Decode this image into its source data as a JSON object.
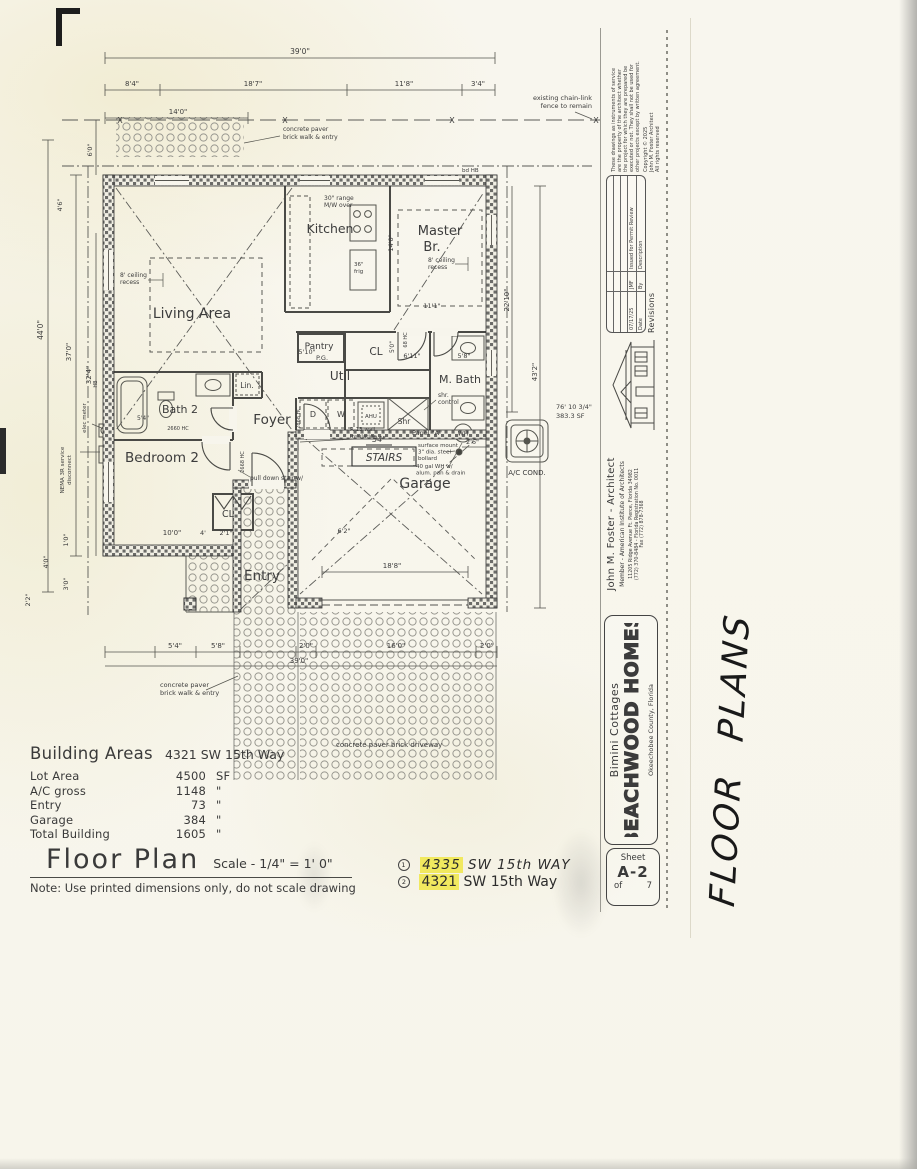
{
  "page": {
    "paper": "#f7f5ec",
    "ink": "#3a3a3a",
    "highlight": "#f1e95f"
  },
  "plan": {
    "rooms": {
      "living": "Living Area",
      "kitchen": "Kitchen",
      "master1": "Master",
      "master2": "Br.",
      "pantry": "Pantry",
      "pg": "P.G.",
      "util": "Util",
      "cl": "CL",
      "mbath": "M. Bath",
      "shr": "Shr",
      "foyer": "Foyer",
      "bath2": "Bath 2",
      "lin": "Lin.",
      "bedroom2": "Bedroom 2",
      "cl2": "CL",
      "entry": "Entry",
      "garage": "Garage",
      "stairs": "STAIRS"
    },
    "dims": {
      "t_overall": "39'0\"",
      "t_a": "8'4\"",
      "t_b": "18'7\"",
      "t_c": "11'8\"",
      "t_d": "3'4\"",
      "t_e": "14'0\"",
      "l_a": "6'0\"",
      "l_b": "4'6\"",
      "l_c": "44'0\"",
      "l_d": "37'0\"",
      "l_e": "32'4\"",
      "l_f": "1'0\"",
      "l_g": "4'0\"",
      "l_h": "3'0\"",
      "l_i": "2'2\"",
      "r_a": "22'10\"",
      "r_b": "43'2\"",
      "r_c": "76' 10 3/4\"",
      "r_d": "383.3 SF",
      "r_e": "2'6\"",
      "b_a": "5'4\"",
      "b_b": "5'8\"",
      "b_c": "2'0\"",
      "b_d": "16'0\"",
      "b_e": "2'0\"",
      "b_f": "39'0\"",
      "i_a": "14'0\"",
      "i_b": "11'1\"",
      "i_c": "5'0\"",
      "i_d": "6'11\"",
      "i_e": "5'8\"",
      "i_f": "10'0\"",
      "i_g": "4'",
      "i_h": "2'1\"",
      "i_i": "6'2\"",
      "i_j": "18'8\"",
      "i_k": "5'10\"",
      "i_l": "5'4\"",
      "i_m": "54\""
    },
    "notes": {
      "fence1": "existing chain-link",
      "fence2": "fence to remain",
      "walk1": "concrete paver",
      "walk2": "brick walk & entry",
      "driveway": "concrete paver brick driveway",
      "range1": "30\" range",
      "range2": "M/W over",
      "frig1": "36\"",
      "frig2": "frig",
      "recess1": "8' ceiling",
      "recess2": "recess",
      "insul1": "R-13 wall",
      "insul2": "insulation",
      "shrctl1": "shr.",
      "shrctl2": "control",
      "panel": "Panel \"A\"",
      "bollard1": "surface mount",
      "bollard2": "3\" dia. steel",
      "bollard3": "bollard",
      "whnote1": "40 gal WH w/",
      "whnote2": "alum. pan & drain",
      "wh": "WH",
      "ahu": "AHU",
      "pulldown": "pull down stair w/",
      "ac": "A/C COND.",
      "elec": "elec meter",
      "nema1": "NEMA 3R service",
      "nema2": "disconnect",
      "hb_top": "bd HB",
      "hb_left": "HB",
      "d": "D",
      "w": "W",
      "door_a": "2868 HC",
      "door_b": "2668 HC",
      "door_c": "2660 HC",
      "door_d": "68 HC",
      "x": "X"
    }
  },
  "titleblock": {
    "copyright": {
      "l1": "These drawings as instruments of service",
      "l2": "are the property of the architect whether",
      "l3": "the project for which they are prepared be",
      "l4": "executed or not. They shall not be used for",
      "l5": "other projects except by written agreement.",
      "l6": "Copyright © 2025",
      "l7": "John M. Foster Architect",
      "l8": "All rights reserved"
    },
    "revisions": {
      "title": "Revisions",
      "date_label": "Date",
      "by_label": "By",
      "desc_label": "Description",
      "row_date": "07/17/25",
      "row_by": "JMF",
      "row_desc": "Issued for Permit Review"
    },
    "architect": {
      "name": "John M. Foster - Architect",
      "member": "Member - American Institute of Architects",
      "address": "11205 Ridge Avenue Ft. Pierce, Florida 34982",
      "phone": "(772) 370-8484 - Florida Registration No. 0011",
      "fax": "Fax (772) 878-7368"
    },
    "project": {
      "line1": "Bimini Cottages",
      "line2": "BEACHWOOD HOMES",
      "line3": "Okeechobee County, Florida"
    },
    "sheet": {
      "label": "Sheet",
      "number": "A-2",
      "of": "of",
      "total": "7"
    }
  },
  "footer": {
    "areas": {
      "title": "Building Areas",
      "address": "4321 SW 15th Way",
      "rows": [
        {
          "label": "Lot Area",
          "value": "4500",
          "unit": "SF"
        },
        {
          "label": "A/C gross",
          "value": "1148",
          "unit": "\""
        },
        {
          "label": "Entry",
          "value": "73",
          "unit": "\""
        },
        {
          "label": "Garage",
          "value": "384",
          "unit": "\""
        },
        {
          "label": "Total Building",
          "value": "1605",
          "unit": "\""
        }
      ],
      "plan_title": "Floor Plan",
      "scale": "Scale - 1/4\" = 1' 0\"",
      "note": "Note: Use printed dimensions only, do not scale drawing"
    },
    "addresses": {
      "a1_num": "1",
      "a1_hl": "4335",
      "a1_rest": "SW 15th WAY",
      "a2_num": "2",
      "a2_hl": "4321",
      "a2_rest": "SW 15th Way"
    }
  },
  "handwriting": {
    "floor_plans": "FLOOR  PLANS"
  }
}
